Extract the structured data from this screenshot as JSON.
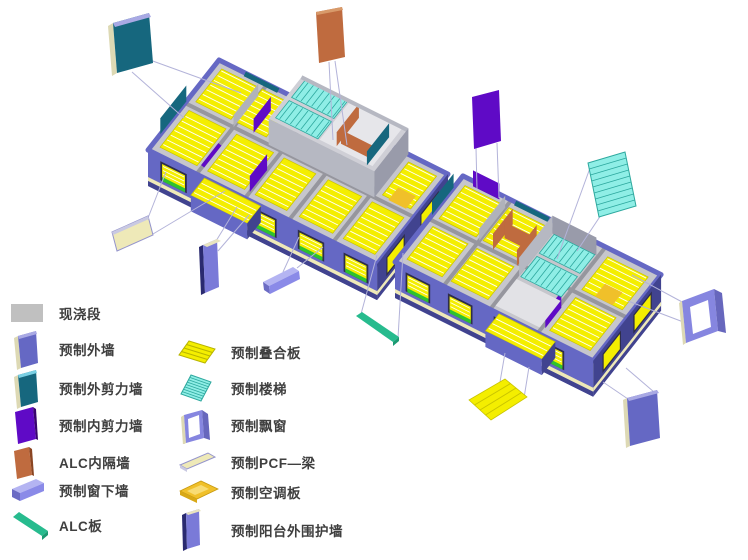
{
  "page": {
    "background": "#ffffff"
  },
  "legend": {
    "items": [
      {
        "id": "cast-in-place-segment",
        "label": "现浇段",
        "color": "#c0c0c0"
      },
      {
        "id": "precast-exterior-wall",
        "label": "预制外墙",
        "color": "#6568c4"
      },
      {
        "id": "precast-exterior-shear-wall",
        "label": "预制外剪力墙",
        "color": "#16677e"
      },
      {
        "id": "precast-interior-shear-wall",
        "label": "预制内剪力墙",
        "color": "#5f0ac6"
      },
      {
        "id": "alc-interior-partition-wall",
        "label": "ALC内隔墙",
        "color": "#bf6b3f"
      },
      {
        "id": "precast-windowsill-wall",
        "label": "预制窗下墙",
        "color": "#8a8ae8"
      },
      {
        "id": "alc-board",
        "label": "ALC板",
        "color": "#27bb8e"
      },
      {
        "id": "precast-composite-slab",
        "label": "预制叠合板",
        "color": "#f4ee00"
      },
      {
        "id": "precast-stairs",
        "label": "预制楼梯",
        "color": "#8feee6"
      },
      {
        "id": "precast-bay-window",
        "label": "预制飘窗",
        "color": "#8686e0"
      },
      {
        "id": "precast-pcf-beam",
        "label": "预制PCF—梁",
        "color": "#eee9b8"
      },
      {
        "id": "precast-ac-panel",
        "label": "预制空调板",
        "color": "#f0c02a"
      },
      {
        "id": "precast-balcony-enclosure-wall",
        "label": "预制阳台外围护墙",
        "color": "#7a7ad8"
      }
    ]
  },
  "diagram": {
    "type": "exploded-axonometric-precast-building",
    "floating_components": [
      "exterior-shear-wall-float",
      "alc-partition-float",
      "interior-shear-wall-float",
      "stairs-float",
      "bay-window-float",
      "exterior-wall-float",
      "composite-slab-float",
      "alc-board-float",
      "pcf-beam-float",
      "balcony-enclosure-float",
      "windowsill-wall-float"
    ]
  },
  "colors": {
    "cast": "#c0c0c0",
    "extwall": "#6568c4",
    "extwallDark": "#41438f",
    "extwallLight": "#a9a9e4",
    "extshear": "#16677e",
    "intshear": "#5f0ac6",
    "alc": "#bf6b3f",
    "sill": "#8a8ae8",
    "alcboard": "#27bb8e",
    "slab": "#f4ee00",
    "slabStripe": "#c9c400",
    "stairs": "#8feee6",
    "bay": "#8686e0",
    "pcf": "#eee9b8",
    "acpanel": "#f0c02a",
    "balcony": "#7a7ad8",
    "green": "#2ec22e",
    "windowDark": "#2e2e4a",
    "leader": "#b3b3d9",
    "topface": "#c6c6cc",
    "wallgray": "#96969e",
    "text": "#3f3f3f"
  }
}
